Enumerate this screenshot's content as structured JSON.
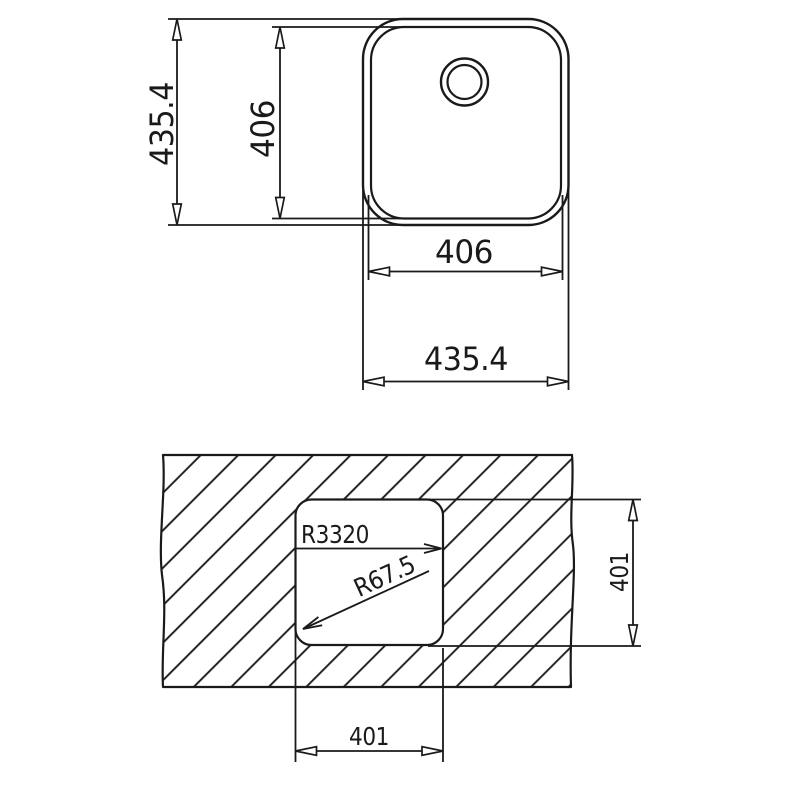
{
  "colors": {
    "ink": "#1a1a1a",
    "background": "#ffffff"
  },
  "top_view": {
    "outer_height": "435.4",
    "inner_height": "406",
    "inner_width": "406",
    "outer_width": "435.4"
  },
  "cutout_view": {
    "bowl_radius": "R3320",
    "corner_radius": "R67.5",
    "cutout_height": "401",
    "cutout_width": "401"
  }
}
